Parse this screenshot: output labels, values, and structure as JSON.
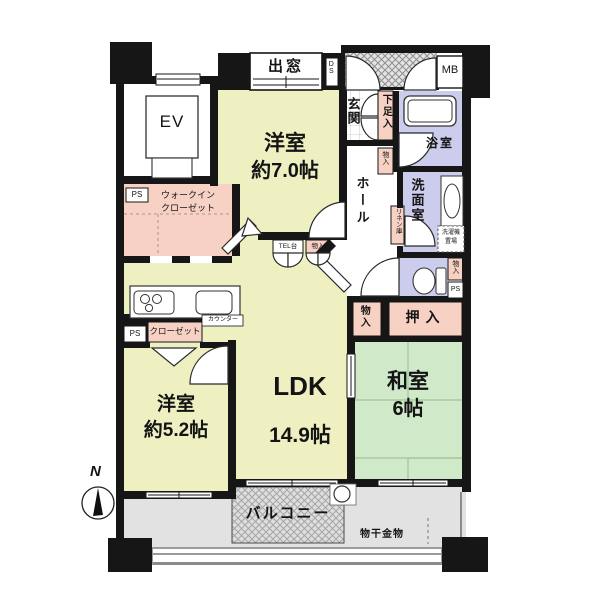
{
  "floor_plan": {
    "rooms": {
      "western_room_7": {
        "name": "洋室",
        "size": "約7.0帖"
      },
      "ldk": {
        "name": "LDK",
        "size": "14.9帖"
      },
      "western_room_5": {
        "name": "洋室",
        "size": "約5.2帖"
      },
      "japanese_room": {
        "name": "和室",
        "size": "6帖"
      }
    },
    "labels": {
      "ev": "EV",
      "bay_window": "出窓",
      "ds": "DS",
      "mb": "MB",
      "entrance": "玄関",
      "shoe_cabinet": "下足入",
      "bathroom": "浴室",
      "hall": "ホール",
      "storage_hall": "物入",
      "linen_cabinet": "リネン庫",
      "washroom": "洗面室",
      "washer_line1": "洗濯機",
      "washer_line2": "置場",
      "storage_toilet": "物入",
      "ps_toilet": "PS",
      "closet_oshiire": "押入",
      "storage_ldk": "物入",
      "walk_in_closet_line1": "ウォークイン",
      "walk_in_closet_line2": "クローゼット",
      "ps_wic": "PS",
      "ps_kitchen": "PS",
      "closet": "クローゼット",
      "counter": "カウンター",
      "tel_stand": "TEL台",
      "storage_tel": "物入",
      "balcony": "バルコニー",
      "laundry_hardware": "物干金物",
      "north": "N"
    },
    "colors": {
      "wall": "#161616",
      "western_room": "#eef0c2",
      "japanese_room": "#cfe9c9",
      "wet_area": "#ccccec",
      "storage": "#f7d2c4",
      "balcony_floor": "#e2e2e2",
      "hatch_gray": "#e0e0e0"
    }
  }
}
